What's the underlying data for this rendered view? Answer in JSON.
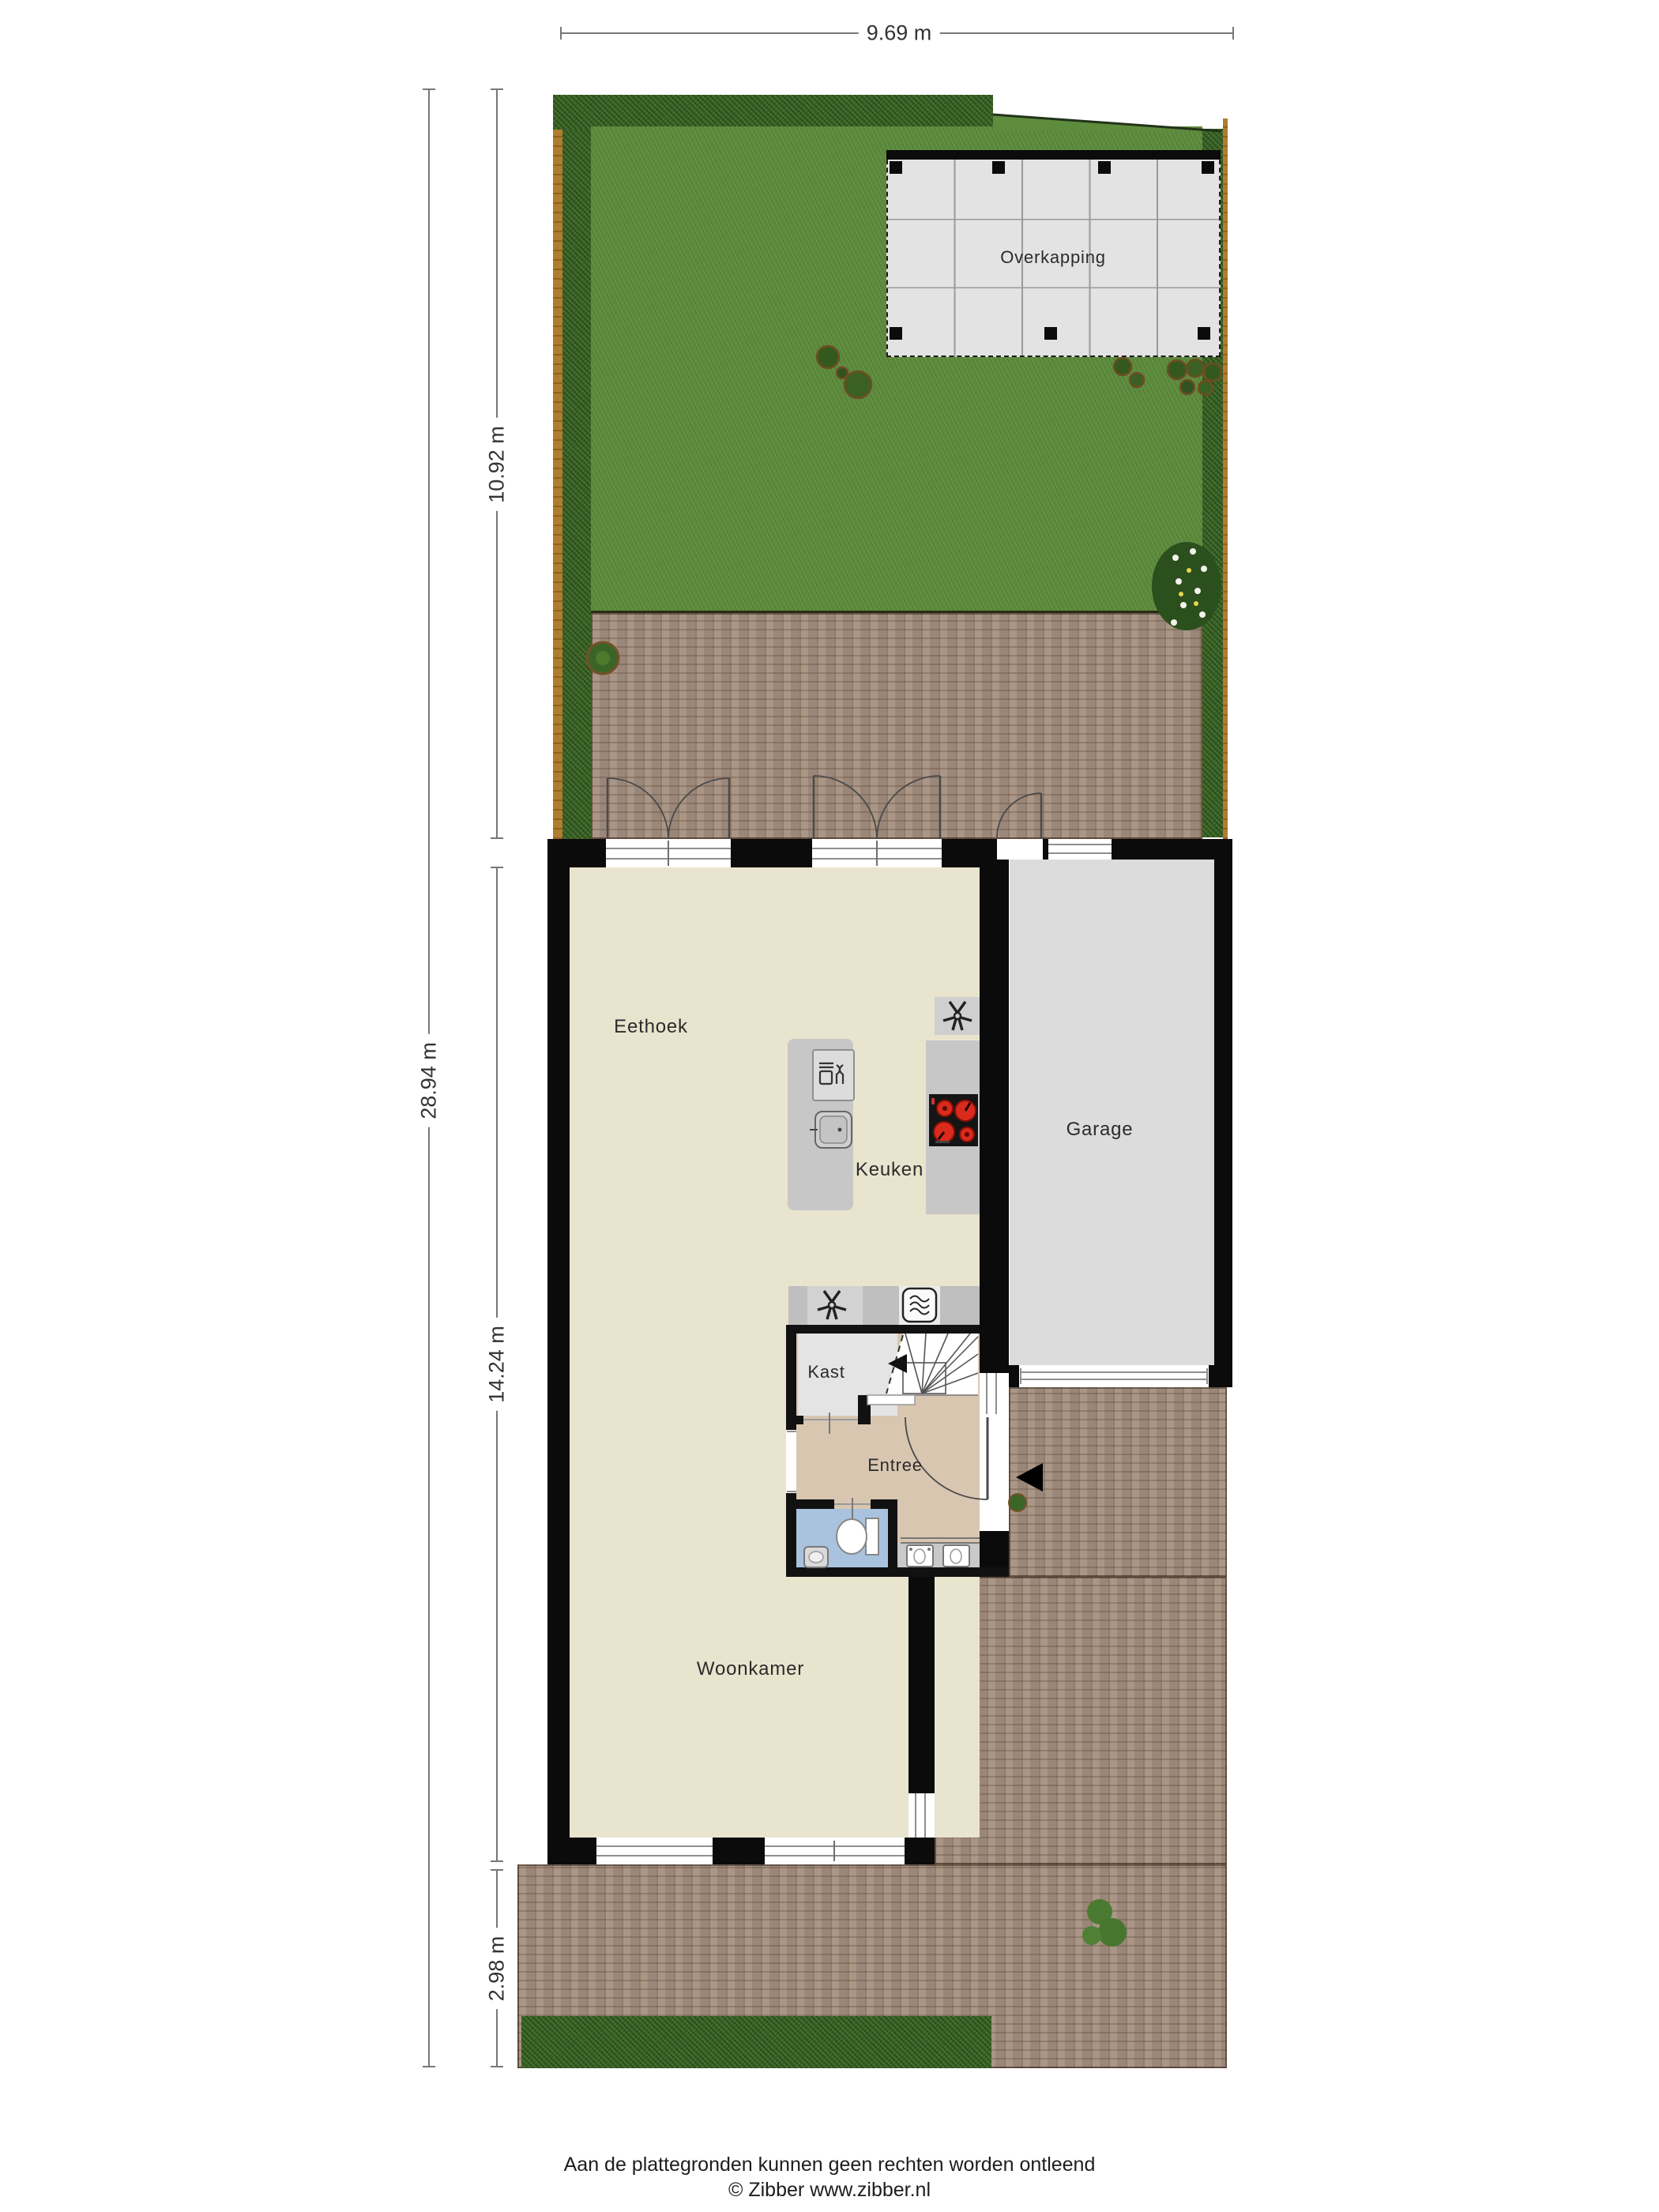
{
  "dimensions": {
    "top_width": "9.69 m",
    "total_depth": "28.94 m",
    "garden_depth": "10.92 m",
    "house_depth": "14.24 m",
    "front_depth": "2.98 m"
  },
  "rooms": {
    "overkapping": "Overkapping",
    "eethoek": "Eethoek",
    "keuken": "Keuken",
    "garage": "Garage",
    "kast": "Kast",
    "entree": "Entree",
    "woonkamer": "Woonkamer"
  },
  "footer": {
    "disclaimer": "Aan de plattegronden kunnen geen rechten worden ontleend",
    "credit": "© Zibber www.zibber.nl"
  },
  "icons": {
    "extractor_fan": "fan-icon",
    "oven": "oven-icon",
    "dishwasher": "dishwasher-icon",
    "sink": "sink-icon",
    "cooktop": "cooktop-4-burners",
    "toilet": "toilet-icon",
    "hand_basin": "basin-icon",
    "entrance_arrow": "entrance-arrow-icon"
  },
  "colors": {
    "wall": "#0b0b0b",
    "floor_main": "#e9e4cd",
    "floor_entree": "#d8c6b1",
    "floor_kast": "#e4e4e4",
    "floor_toilet": "#a9c3de",
    "floor_garage": "#dcdcdc",
    "lawn": "#5e8c3d",
    "hedge": "#3b6625",
    "fence": "#b07c30",
    "paving": "#a6907f",
    "overkapping": "#e3e3e3",
    "burner_red": "#d92b1c"
  }
}
